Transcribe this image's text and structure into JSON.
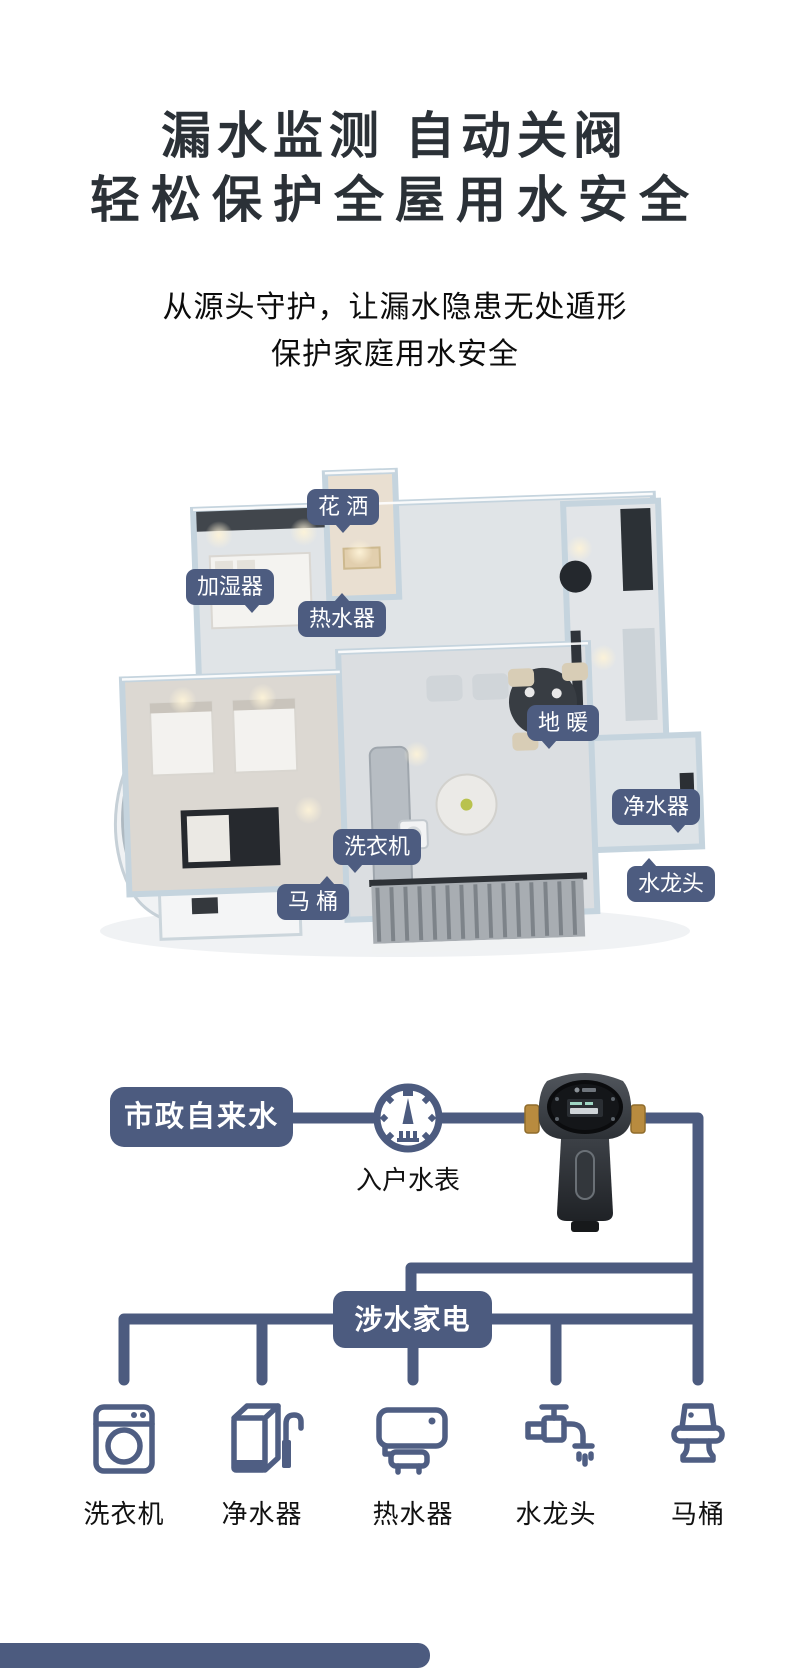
{
  "hero": {
    "title_line1": "漏水监测 自动关阀",
    "title_line2": "轻松保护全屋用水安全",
    "subtitle_line1": "从源头守护，让漏水隐患无处遁形",
    "subtitle_line2": "保护家庭用水安全"
  },
  "floorplan": {
    "callouts": [
      {
        "label": "花 洒"
      },
      {
        "label": "加湿器"
      },
      {
        "label": "热水器"
      },
      {
        "label": "地 暖"
      },
      {
        "label": "净水器"
      },
      {
        "label": "洗衣机"
      },
      {
        "label": "马 桶"
      },
      {
        "label": "水龙头"
      }
    ]
  },
  "flow": {
    "source_label": "市政自来水",
    "meter_label": "入户水表",
    "meter_icon": "water-meter-gauge-icon",
    "device_image": "smart-water-valve-photo",
    "hub_label": "涉水家电",
    "appliances": [
      {
        "label": "洗衣机",
        "icon": "washing-machine-icon"
      },
      {
        "label": "净水器",
        "icon": "water-purifier-icon"
      },
      {
        "label": "热水器",
        "icon": "water-heater-icon"
      },
      {
        "label": "水龙头",
        "icon": "faucet-icon"
      },
      {
        "label": "马桶",
        "icon": "toilet-icon"
      }
    ]
  },
  "colors": {
    "accent_blue": "#4c5b7f",
    "title_dark": "#2b3137",
    "text_black": "#111111",
    "brass": "#b88b3f"
  }
}
